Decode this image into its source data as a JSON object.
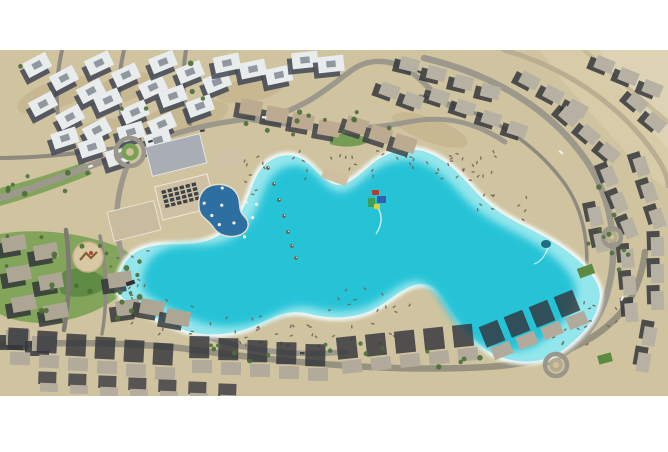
{
  "meta": {
    "description": "Aerial photograph of a desert residential compound built around a large turquoise crystal lagoon with sandy beaches, clubhouse, pools and rings of villas",
    "photo_area": {
      "x": 0,
      "y": 50,
      "width": 668,
      "height": 346
    }
  },
  "palette": {
    "page_bg": "#ffffff",
    "sand": "#d0c4a0",
    "desert": "#d7cba8",
    "desert_light": "#ddd3b4",
    "dirt": "#c3b48c",
    "road": "#9d988c",
    "road_minor": "#8e8a80",
    "road_desert": "#c0b493",
    "foam": "#f1fbfa",
    "shallow": "#93e6ec",
    "deep": "#27c3d7",
    "pool": "#2d6fa0",
    "pool_deck": "#e2dfd2",
    "green": "#7da257",
    "green_dark": "#5d8a43",
    "tree": "#4a6f38",
    "furniture": "#6b6254",
    "umbrella_white": "#f2efe8",
    "playground_sand": "#d8c9a4",
    "playground_gear": "#8a5a34",
    "playground_red": "#b04434"
  },
  "row_styles": {
    "apt": {
      "roof": "#e9ecec",
      "shadow": "#3a4250",
      "sdx": -5,
      "sdy": 5,
      "w": 26,
      "h": 16,
      "slot": true
    },
    "villa_n": {
      "roof": "#bcab90",
      "shadow": "#3a3d42",
      "sdx": -5,
      "sdy": 5,
      "w": 22,
      "h": 15
    },
    "villa_r": {
      "roof": "#b7b1a3",
      "shadow": "#2e3237",
      "sdx": -6,
      "sdy": 4,
      "w": 19,
      "h": 13
    },
    "villa_l": {
      "roof": "#aea694",
      "shadow": "#2e3237",
      "sdx": -7,
      "sdy": 5,
      "w": 24,
      "h": 15
    },
    "villa_b": {
      "roof": "#b2ab9c",
      "shadow": "#33363c",
      "sdx": -3,
      "sdy": -14,
      "w": 20,
      "h": 13,
      "shh": 1.7
    },
    "villa_b2": {
      "roof": "#b5ae9f",
      "shadow": "#3a3d42",
      "sdx": -2,
      "sdy": -8,
      "w": 18,
      "h": 9,
      "shh": 1.4
    }
  },
  "scene": {
    "desert_patches": [
      {
        "d": "M540,50 L668,50 L668,190 C630,162 600,122 576,96 C561,80 549,63 540,50 Z",
        "fill": "#d7cba8"
      },
      {
        "d": "M600,50 L668,50 L668,150 C640,116 616,82 600,50 Z",
        "fill": "#ddd3b4"
      }
    ],
    "dirt_patches": [
      [
        55,
        95,
        40,
        14,
        -20
      ],
      [
        120,
        90,
        40,
        13,
        -18
      ],
      [
        180,
        120,
        50,
        16,
        -15
      ],
      [
        90,
        135,
        36,
        12,
        -20
      ],
      [
        250,
        90,
        34,
        12,
        -10
      ],
      [
        430,
        130,
        40,
        12,
        20
      ]
    ],
    "greens": [
      {
        "d": "M0,206 C28,198 58,188 92,174 L84,162 C52,174 24,182 0,188 Z",
        "fill": "#7da257"
      },
      {
        "d": "M0,234 C36,228 78,232 116,246 C138,254 142,270 130,286 C112,306 84,318 56,322 C32,325 10,320 0,314 Z",
        "fill": "#7da257"
      },
      {
        "d": "M66,270 C84,266 102,272 110,284 C98,296 78,300 62,294 C56,286 58,276 66,270 Z",
        "fill": "#5d8a43"
      },
      {
        "d": "M330,136 C344,132 360,134 372,140 C360,148 342,148 330,144 Z",
        "fill": "#6f9a50"
      }
    ],
    "roads": [
      {
        "d": "M0,198 C36,188 78,170 114,157",
        "w": 7,
        "c": "#9d988c"
      },
      {
        "d": "M143,145 C185,128 225,121 258,118 C300,114 330,86 352,70 C372,56 398,60 416,76 C430,88 440,100 452,108",
        "w": 5.5,
        "c": "#9d988c"
      },
      {
        "d": "M252,120 C310,128 360,132 408,122 C448,114 478,124 505,142",
        "w": 5,
        "c": "#9d988c"
      },
      {
        "d": "M127,166 C116,196 112,228 124,260 C136,296 164,320 205,336 C248,352 300,356 345,352",
        "w": 5.5,
        "c": "#9d988c"
      },
      {
        "d": "M0,345 C60,342 120,342 180,348 C280,362 400,374 500,366 C550,361 592,344 618,316 C634,298 642,276 645,252",
        "w": 6.5,
        "c": "#97927f"
      },
      {
        "d": "M424,58 C492,74 550,108 586,160 C612,198 620,248 607,294 C598,326 576,350 548,362",
        "w": 6.5,
        "c": "#9d988c"
      },
      {
        "d": "M504,50 C566,68 620,104 656,156 C664,168 668,178 668,186",
        "w": 5,
        "c": "#b9ae92"
      },
      {
        "d": "M584,50 L668,122",
        "w": 4,
        "c": "#c7bb98"
      },
      {
        "d": "M62,50 C56,78 54,106 62,134",
        "w": 4,
        "c": "#8e8a80"
      },
      {
        "d": "M124,50 C118,76 116,104 126,132",
        "w": 4,
        "c": "#8e8a80"
      },
      {
        "d": "M186,50 C182,74 182,100 190,124",
        "w": 4,
        "c": "#8e8a80"
      },
      {
        "d": "M0,158 C40,158 90,152 130,146",
        "w": 4,
        "c": "#8e8a80"
      },
      {
        "d": "M66,230 C70,262 70,296 64,330",
        "w": 4.5,
        "c": "#7e7a72"
      },
      {
        "d": "M100,236 C106,266 108,300 102,334",
        "w": 3.5,
        "c": "#8e8a80"
      },
      {
        "d": "M420,96 C480,108 530,138 562,180 C585,210 592,252 583,292",
        "w": 3.5,
        "c": "#8e8a80"
      }
    ],
    "lagoon": {
      "d": "M118,287 C119,268 127,254 145,248 C163,242 180,246 198,243 C216,240 230,230 240,214 C250,198 252,180 262,168 C272,156 288,152 300,158 C312,164 318,176 331,183 C344,190 358,176 372,164 C386,152 408,146 426,152 C444,158 458,172 474,190 C490,208 508,218 528,228 C548,238 572,252 586,268 C600,284 602,292 598,306 C594,322 578,340 560,352 C542,364 518,364 498,356 C478,348 462,326 450,306 C442,292 434,284 422,284 C406,284 394,298 376,308 C358,318 334,320 310,314 C286,308 272,318 254,326 C236,334 208,338 184,330 C160,322 136,308 124,299 C119,295 118,291 118,287 Z",
      "centroid": [
        360,
        255
      ],
      "inner_scale": 0.9
    },
    "rows": [
      {
        "s": "apt",
        "p": [
          24,
          57,
          27,
          13,
          3,
          -28
        ]
      },
      {
        "s": "apt",
        "p": [
          86,
          55,
          27,
          12,
          3,
          -25
        ]
      },
      {
        "s": "apt",
        "p": [
          150,
          54,
          27,
          10,
          3,
          -22
        ]
      },
      {
        "s": "apt",
        "p": [
          30,
          96,
          27,
          13,
          3,
          -28
        ]
      },
      {
        "s": "apt",
        "p": [
          95,
          92,
          27,
          12,
          3,
          -24
        ]
      },
      {
        "s": "apt",
        "p": [
          160,
          88,
          27,
          10,
          2,
          -20
        ]
      },
      {
        "s": "apt",
        "p": [
          52,
          130,
          27,
          9,
          3,
          -18
        ]
      },
      {
        "s": "apt",
        "p": [
          118,
          124,
          27,
          8,
          2,
          -16
        ]
      },
      {
        "s": "apt",
        "p": [
          214,
          55,
          26,
          6,
          3,
          -12
        ]
      },
      {
        "s": "apt",
        "p": [
          292,
          52,
          26,
          4,
          2,
          -6
        ]
      },
      {
        "s": "villa_n",
        "p": [
          240,
          100,
          26,
          7,
          4,
          10
        ]
      },
      {
        "s": "villa_n",
        "p": [
          346,
          118,
          24,
          9,
          3,
          18
        ]
      },
      {
        "s": "villa_r",
        "p": [
          400,
          58,
          27,
          9,
          4,
          14
        ]
      },
      {
        "s": "villa_r",
        "p": [
          430,
          90,
          26,
          11,
          4,
          18
        ]
      },
      {
        "s": "villa_r",
        "p": [
          520,
          74,
          24,
          14,
          3,
          28
        ]
      },
      {
        "s": "villa_r",
        "p": [
          560,
          110,
          20,
          18,
          3,
          40
        ]
      },
      {
        "s": "villa_r",
        "p": [
          595,
          58,
          24,
          12,
          3,
          22
        ]
      },
      {
        "s": "villa_r",
        "p": [
          628,
          96,
          18,
          20,
          2,
          40
        ]
      },
      {
        "s": "villa_r",
        "p": [
          600,
          170,
          10,
          26,
          3,
          68
        ]
      },
      {
        "s": "villa_r",
        "p": [
          632,
          160,
          8,
          26,
          3,
          72
        ]
      },
      {
        "s": "villa_r",
        "p": [
          618,
          252,
          2,
          27,
          3,
          85
        ]
      },
      {
        "s": "villa_r",
        "p": [
          648,
          240,
          0,
          27,
          3,
          88
        ]
      },
      {
        "s": "villa_r",
        "p": [
          586,
          210,
          6,
          26,
          2,
          78
        ]
      },
      {
        "s": "villa_r",
        "p": [
          640,
          330,
          -6,
          26,
          2,
          100
        ]
      },
      {
        "s": "villa_r",
        "p": [
          380,
          84,
          24,
          10,
          2,
          20
        ]
      },
      {
        "s": "villa_l",
        "p": [
          2,
          236,
          5,
          30,
          3,
          -10
        ]
      },
      {
        "s": "villa_l",
        "p": [
          34,
          244,
          5,
          30,
          3,
          -10
        ]
      },
      {
        "s": "villa_l",
        "p": [
          6,
          330,
          26,
          6,
          2,
          0
        ]
      },
      {
        "s": "villa_l",
        "p": [
          108,
          272,
          8,
          28,
          2,
          -8
        ]
      },
      {
        "s": "villa_l",
        "p": [
          140,
          300,
          26,
          10,
          2,
          10
        ]
      },
      {
        "s": "villa_b",
        "p": [
          10,
          352,
          29,
          3,
          6,
          3
        ]
      },
      {
        "s": "villa_b",
        "p": [
          192,
          360,
          29,
          2,
          5,
          1
        ]
      },
      {
        "s": "villa_b",
        "p": [
          342,
          360,
          29,
          -3,
          5,
          -6
        ]
      },
      {
        "s": "villa_b",
        "p": [
          492,
          344,
          25,
          -10,
          4,
          -22
        ]
      },
      {
        "s": "villa_b2",
        "p": [
          40,
          383,
          30,
          2,
          7,
          2
        ]
      }
    ],
    "rects": [
      [
        148,
        140,
        56,
        30,
        -14,
        "#a9aeb4",
        "#e4e5e3"
      ],
      [
        158,
        180,
        54,
        34,
        -14,
        "#cec0a2",
        "#eee8da"
      ],
      [
        110,
        206,
        48,
        30,
        -14,
        "#c9bb9e",
        "#e8e2d4"
      ],
      [
        216,
        148,
        26,
        18,
        -14,
        "#cfc2a6",
        ""
      ],
      [
        322,
        172,
        26,
        10,
        20,
        "#cdbf9f",
        ""
      ],
      [
        578,
        266,
        16,
        10,
        -20,
        "#5d8a43",
        ""
      ],
      [
        598,
        354,
        14,
        9,
        -15,
        "#5d8a43",
        ""
      ],
      [
        126,
        281,
        9,
        4,
        -20,
        "#2c2f33",
        ""
      ]
    ],
    "solar": {
      "x": 163,
      "y": 186,
      "cols": 6,
      "rows": 4,
      "cw": 6.2,
      "ch": 4.8,
      "dw": 4.4,
      "dh": 3.4,
      "a": -14,
      "color": "#3d4248"
    },
    "pool": {
      "d": "M206,188 c12,-7 26,-3 31,6 c5,9 0,15 7,22 c7,7 5,15 -4,19 c-11,4 -22,0 -27,-8 c-5,-8 -13,-9 -14,-19 c-1,-9 1,-15 7,-20 z"
    },
    "roundabouts": [
      {
        "cx": 130,
        "cy": 152,
        "r": 14,
        "ring": "#9b968a",
        "inner": "#79a153",
        "center": "#cec09c"
      },
      {
        "cx": 556,
        "cy": 365,
        "r": 11,
        "ring": "#9b968a",
        "inner": "#b4aa8c",
        "center": "#cec09c"
      },
      {
        "cx": 612,
        "cy": 237,
        "r": 9,
        "ring": "#9b968a",
        "inner": "#b4aa8c",
        "center": "#cec09c"
      }
    ],
    "playground": {
      "cx": 88,
      "cy": 257,
      "r": 15
    },
    "furniture_zones": [
      [
        295,
        148,
        200,
        34,
        45
      ],
      [
        236,
        152,
        34,
        42,
        10
      ],
      [
        112,
        246,
        44,
        50,
        12
      ],
      [
        128,
        292,
        64,
        42,
        14
      ],
      [
        182,
        316,
        84,
        28,
        12
      ],
      [
        258,
        322,
        66,
        24,
        10
      ],
      [
        330,
        286,
        84,
        28,
        12
      ],
      [
        302,
        322,
        92,
        20,
        10
      ],
      [
        475,
        190,
        54,
        30,
        10
      ],
      [
        585,
        300,
        34,
        44,
        10
      ],
      [
        540,
        320,
        40,
        26,
        8
      ]
    ],
    "tree_zones": [
      [
        4,
        232,
        130,
        86,
        14
      ],
      [
        2,
        172,
        86,
        26,
        8
      ],
      [
        240,
        112,
        170,
        24,
        12
      ],
      [
        104,
        240,
        44,
        84,
        9
      ],
      [
        200,
        340,
        330,
        28,
        16
      ],
      [
        588,
        180,
        44,
        140,
        10
      ],
      [
        20,
        60,
        200,
        80,
        6
      ]
    ],
    "white_umbrella_zone": [
      196,
      188,
      64,
      54,
      10
    ],
    "shore_umbrellas": [
      [
        268,
        168
      ],
      [
        274,
        184
      ],
      [
        279,
        200
      ],
      [
        284,
        216
      ],
      [
        288,
        232
      ],
      [
        292,
        246
      ],
      [
        296,
        258
      ]
    ],
    "cars": [
      [
        88,
        166,
        -20,
        "#f0f0ee"
      ],
      [
        148,
        141,
        -18,
        "#3a3d40"
      ],
      [
        262,
        116,
        5,
        "#f0f0ee"
      ],
      [
        418,
        70,
        25,
        "#44484c"
      ],
      [
        560,
        150,
        40,
        "#f0f0ee"
      ],
      [
        300,
        352,
        2,
        "#3a3d40"
      ],
      [
        620,
        300,
        -60,
        "#f0f0ee"
      ],
      [
        200,
        130,
        -10,
        "#3a3d40"
      ]
    ],
    "inflatables": {
      "one": [
        [
          372,
          190,
          7,
          5,
          "#c03a2c"
        ],
        [
          377,
          196,
          9,
          7,
          "#2f5fae"
        ],
        [
          368,
          198,
          7,
          9,
          "#3f9e50"
        ],
        [
          374,
          204,
          6,
          5,
          "#d8d23c"
        ]
      ],
      "one_wake": "M378,208 c6,10 2,20 -2,26",
      "two": {
        "cx": 546,
        "cy": 244,
        "rx": 5,
        "ry": 4,
        "fill": "#1f6f80"
      },
      "two_wake": "M548,248 c-4,10 -8,14 -14,16"
    }
  }
}
